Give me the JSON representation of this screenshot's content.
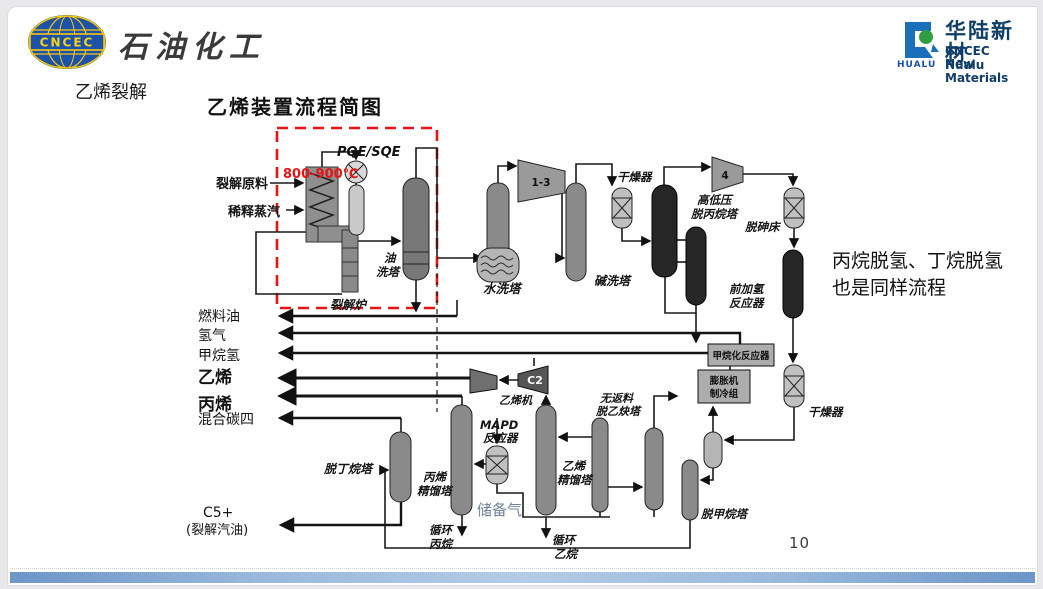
{
  "header": {
    "cncec_logo_text": "CNCEC",
    "brand_text": "石油化工",
    "hualu_glyph_text": "HUALU",
    "hualu_cn": "华陆新材",
    "hualu_en1": "CNCEC Hualu",
    "hualu_en2": "New Materials"
  },
  "slide": {
    "section_title": "乙烯裂解",
    "diagram_title": "乙烯装置流程简图",
    "side_note_line1": "丙烷脱氢、丁烷脱氢",
    "side_note_line2": "也是同样流程",
    "page_number": "10"
  },
  "diagram": {
    "colors": {
      "annotation_red": "#e81414",
      "storage_text": "#72849c",
      "line_black": "#1a1a1a"
    },
    "labels": {
      "feed1": "裂解原料",
      "feed2": "稀释蒸汽",
      "pqe": "PQE/SQE",
      "temp": "800-900℃",
      "furnace": "裂解炉",
      "oilwash1": "油",
      "oilwash2": "洗塔",
      "waterwash": "水洗塔",
      "causticwash": "碱洗塔",
      "dryer1": "干燥器",
      "comp13": "1-3",
      "comp4": "4",
      "depropanizer1": "高低压",
      "depropanizer2": "脱丙烷塔",
      "arsenic": "脱砷床",
      "hydrotreat1": "前加氢",
      "hydrotreat2": "反应器",
      "methanation": "甲烷化反应器",
      "expander1": "膨胀机",
      "expander2": "制冷组",
      "dryer2": "干燥器",
      "demethanizer": "脱甲烷塔",
      "c2splitter1": "乙烯",
      "c2splitter2": "精馏塔",
      "deethanizer1": "无返料",
      "deethanizer2": "脱乙炔塔",
      "c2comp": "C2",
      "ethylenecomp": "乙烯机",
      "mapd1": "MAPD",
      "mapd2": "反应器",
      "storage": "储备气",
      "c3splitter1": "丙烯",
      "c3splitter2": "精馏塔",
      "recyclepropane1": "循环",
      "recyclepropane2": "丙烷",
      "recycleethane1": "循环",
      "recycleethane2": "乙烷",
      "debutanizer": "脱丁烷塔",
      "fueloil": "燃料油",
      "hydrogen": "氢气",
      "methaneh": "甲烷氢",
      "ethylene": "乙烯",
      "propylene": "丙烯",
      "mixedc4": "混合碳四",
      "c5": "C5+",
      "pygas": "(裂解汽油)"
    }
  }
}
